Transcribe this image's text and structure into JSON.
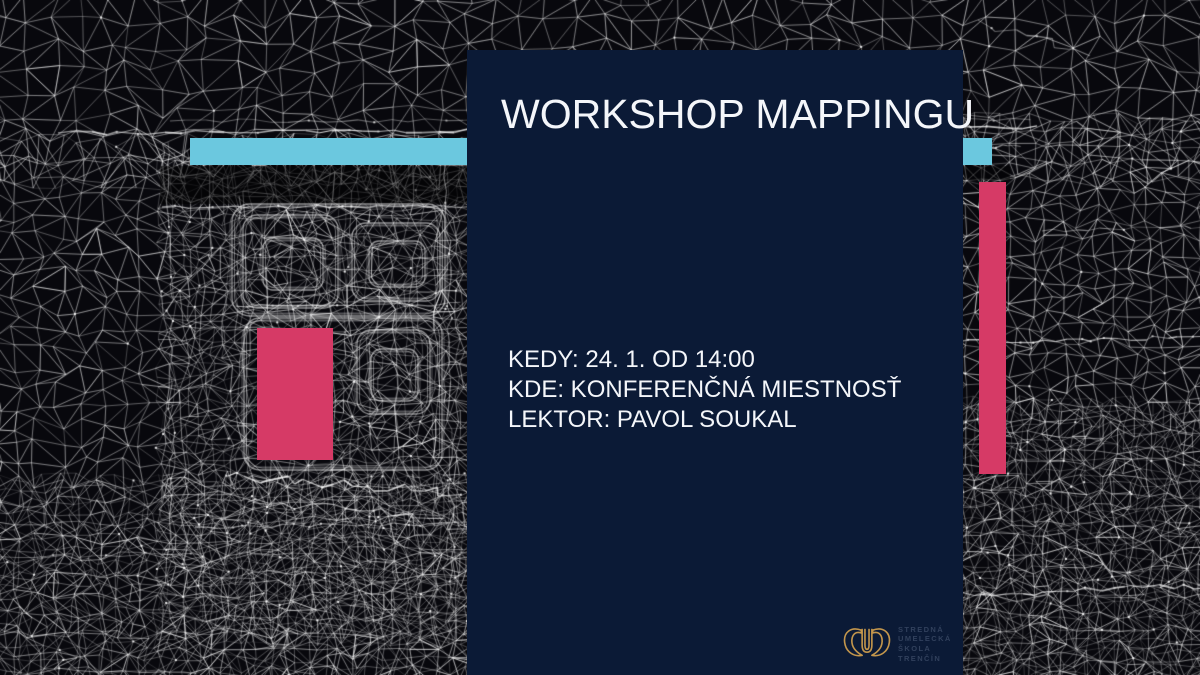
{
  "poster": {
    "title": "WORKSHOP MAPPINGU",
    "detail_lines": [
      "KEDY: 24. 1. OD 14:00",
      "KDE: KONFERENČNÁ MIESTNOSŤ",
      "LEKTOR: PAVOL SOUKAL"
    ]
  },
  "logo": {
    "name_lines": [
      "STREDNÁ",
      "UMELECKÁ",
      "ŠKOLA",
      "TRENČÍN"
    ],
    "emblem": "school-emblem-icon"
  },
  "colors": {
    "background": "#08080d",
    "panel_navy": "#0b1a36",
    "accent_cyan": "#6bc8df",
    "accent_pink": "#d63a66",
    "title_text": "#f4f6fa",
    "logo_gold": "#c3964c",
    "logo_text": "#31405c",
    "mesh_line": "#ffffff"
  }
}
